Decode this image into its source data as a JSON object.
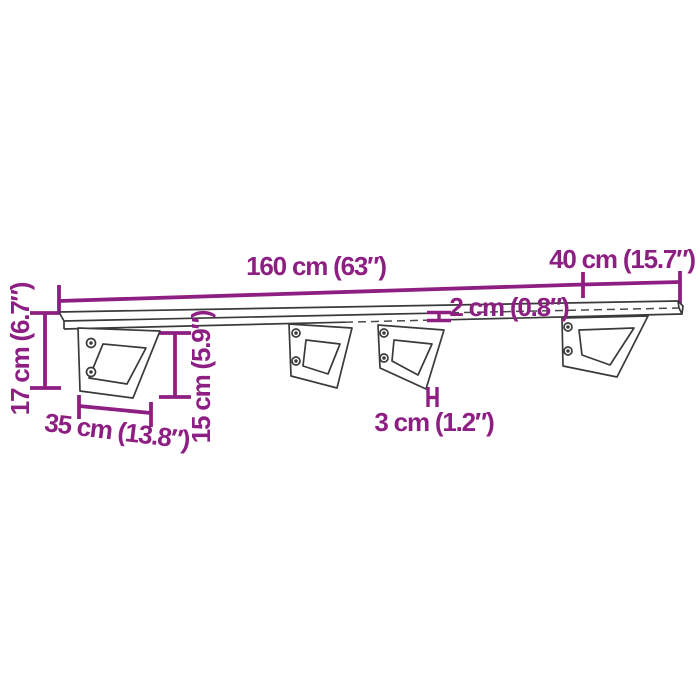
{
  "labels": {
    "length": "160 cm (63″)",
    "depth": "40 cm (15.7″)",
    "thickness": "2 cm (0.8″)",
    "bar_width": "3 cm (1.2″)",
    "bracket_depth": "35 cm (13.8″)",
    "bracket_height": "15 cm (5.9″)",
    "overall_height": "17 cm (6.7″)"
  },
  "colors": {
    "dimension": "#8E1F82",
    "outline": "#3A3A3A",
    "background": "#FFFFFF"
  }
}
